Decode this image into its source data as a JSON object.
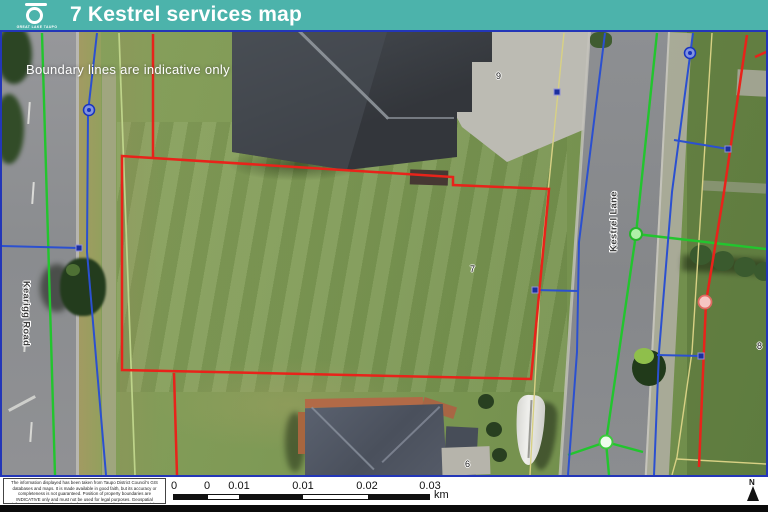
{
  "header": {
    "logo_text": "GREAT LAKE TAUPO",
    "title": "7 Kestrel services map",
    "bg_color": "#4cb3ab"
  },
  "map": {
    "note": "Boundary lines are indicative only",
    "road_labels": {
      "left": "Kearigg Road",
      "right": "Kestrel Lane"
    },
    "parcel_numbers": [
      "9",
      "7",
      "6",
      "8"
    ],
    "layer_colors": {
      "boundary_red": "#e8231a",
      "water_blue": "#2b50d0",
      "green_service": "#22c52e",
      "pale_green_service": "#bed48a",
      "yellow_service": "#d8d184"
    }
  },
  "footer": {
    "disclaimer": "The information displayed has been taken from Taupo District Council's GIS databases and maps. It is made available in good faith, but its accuracy or completeness is not guaranteed. Position of property boundaries are INDICATIVE only and must not be used for legal purposes. Geospatial information sourced from Land Information New Zealand. Crown Copyright Reserved. This map is not to be reproduced without permission of TDC. © Copyright Reserved Taupo District Council.",
    "scalebar": {
      "labels": [
        "0",
        "0",
        "0.01",
        "0.01",
        "0.02",
        "0.03"
      ],
      "unit": "km"
    },
    "north_label": "N"
  }
}
